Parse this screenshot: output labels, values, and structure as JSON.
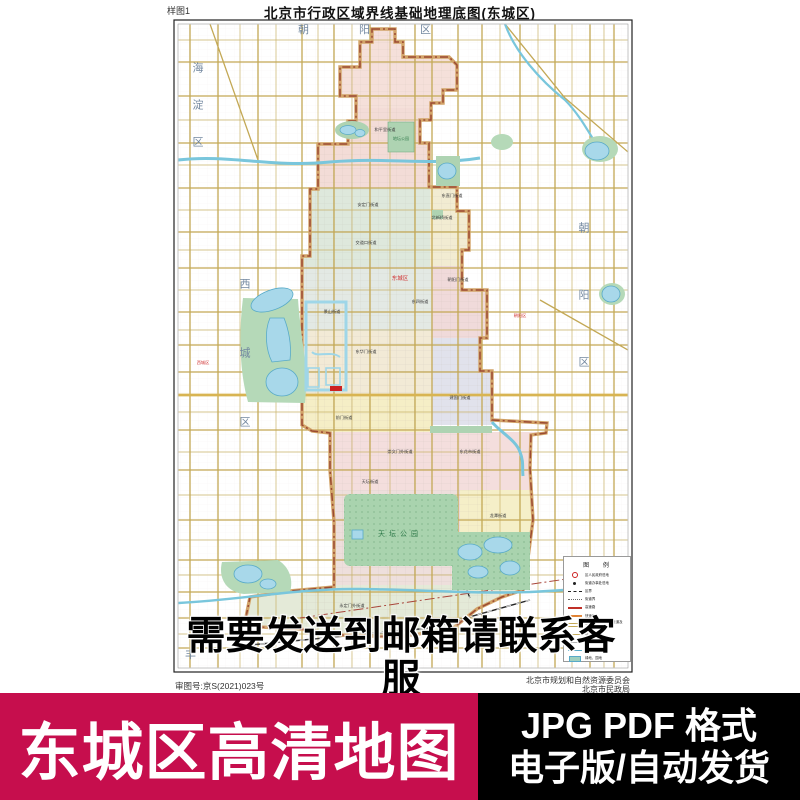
{
  "header": {
    "sample_label": "样图1",
    "title": "北京市行政区域界线基础地理底图(东城区)"
  },
  "map": {
    "districts": {
      "haidian": "海淀区",
      "chaoyang_top": "朝阳区",
      "xicheng": "西城区",
      "chaoyang_right": "朝阳区",
      "fengtai_partial": "丰"
    },
    "red_labels": {
      "dongcheng": "东城区",
      "left": "西城区",
      "right": "朝阳区"
    },
    "parks": {
      "tiantan": "天坛公园",
      "ditan": "地坛公园"
    },
    "streets": [
      "和平里街道",
      "安定门街道",
      "北新桥街道",
      "交道口街道",
      "东直门街道",
      "东四街道",
      "朝阳门街道",
      "景山街道",
      "东华门街道",
      "建国门街道",
      "前门街道",
      "崇文门外街道",
      "东花市街道",
      "天坛街道",
      "龙潭街道",
      "永定门外街道"
    ],
    "legend": {
      "title": "图 例",
      "items": [
        {
          "label": "区人民政府驻地"
        },
        {
          "label": "街道办事处驻地"
        },
        {
          "label": "区界"
        },
        {
          "label": "街道界"
        },
        {
          "label": "高速路"
        },
        {
          "label": "快速路"
        },
        {
          "label": "高速公路、快速路匝道及下道"
        },
        {
          "label": "城市主干道"
        },
        {
          "label": "一般道路"
        },
        {
          "label": "河流、湖泊"
        },
        {
          "label": "绿地、园地"
        }
      ]
    }
  },
  "overlay_notice": "需要发送到邮箱请联系客服",
  "credits": {
    "approval_no": "审图号:京S(2021)023号",
    "org_line1": "北京市规划和自然资源委员会",
    "org_line2": "北京市民政局"
  },
  "banner": {
    "left_text": "东城区高清地图",
    "right_line1": "JPG PDF 格式",
    "right_line2": "电子版/自动发货"
  },
  "colors": {
    "banner_left_bg": "#c60e4d",
    "banner_right_bg": "#000000",
    "district_boundary": "#9b4a32",
    "ring_road": "#d2a368",
    "road_tan": "#c3a855",
    "water_fill": "#a8d8ea",
    "water_stroke": "#58aac8",
    "park_green": "#a9d3ae",
    "district_label_blue": "#7388a0"
  }
}
